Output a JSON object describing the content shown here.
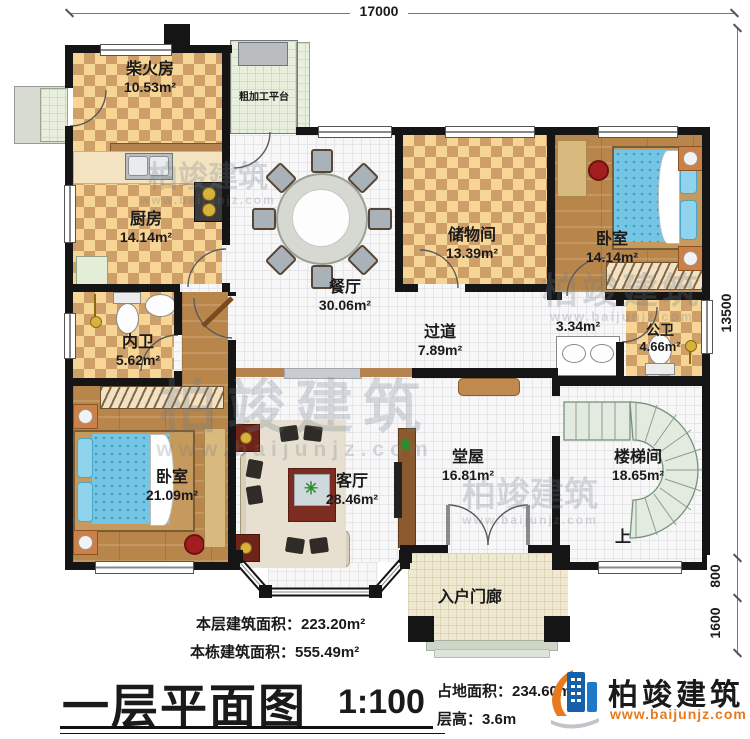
{
  "dimensions": {
    "top": "17000",
    "right": "13500",
    "r800": "800",
    "r1600": "1600"
  },
  "rooms": {
    "firewood": {
      "name": "柴火房",
      "area": "10.53m²"
    },
    "platform": {
      "name": "粗加工平台"
    },
    "kitchen": {
      "name": "厨房",
      "area": "14.14m²"
    },
    "dining": {
      "name": "餐厅",
      "area": "30.06m²"
    },
    "storage": {
      "name": "储物间",
      "area": "13.39m²"
    },
    "bedroom_ne": {
      "name": "卧室",
      "area": "14.14m²"
    },
    "hallway": {
      "name": "过道",
      "area": "7.89m²"
    },
    "wash_area": {
      "area": "3.34m²"
    },
    "public_bath": {
      "name": "公卫",
      "area": "4.66m²"
    },
    "private_bath": {
      "name": "内卫",
      "area": "5.62m²"
    },
    "bedroom_sw": {
      "name": "卧室",
      "area": "21.09m²"
    },
    "living": {
      "name": "客厅",
      "area": "28.46m²"
    },
    "hall": {
      "name": "堂屋",
      "area": "16.81m²"
    },
    "stairwell": {
      "name": "楼梯间",
      "area": "18.65m²"
    },
    "porch": {
      "name": "入户门廊"
    }
  },
  "stairs": {
    "up": "上"
  },
  "watermark": {
    "brand": "柏竣建筑",
    "site": "www.baijunjz.com"
  },
  "footer": {
    "floor_area": "本层建筑面积：223.20m²",
    "building_area": "本栋建筑面积：555.49m²",
    "title": "一层平面图",
    "scale": "1:100",
    "land_area": "占地面积：234.60m²",
    "floor_height": "层高：3.6m",
    "brand": "柏竣建筑",
    "site": "www.baijunjz.com"
  },
  "colors": {
    "accent_orange": "#e87a1e",
    "brand_blue": "#1560a8",
    "wall": "#151515"
  }
}
